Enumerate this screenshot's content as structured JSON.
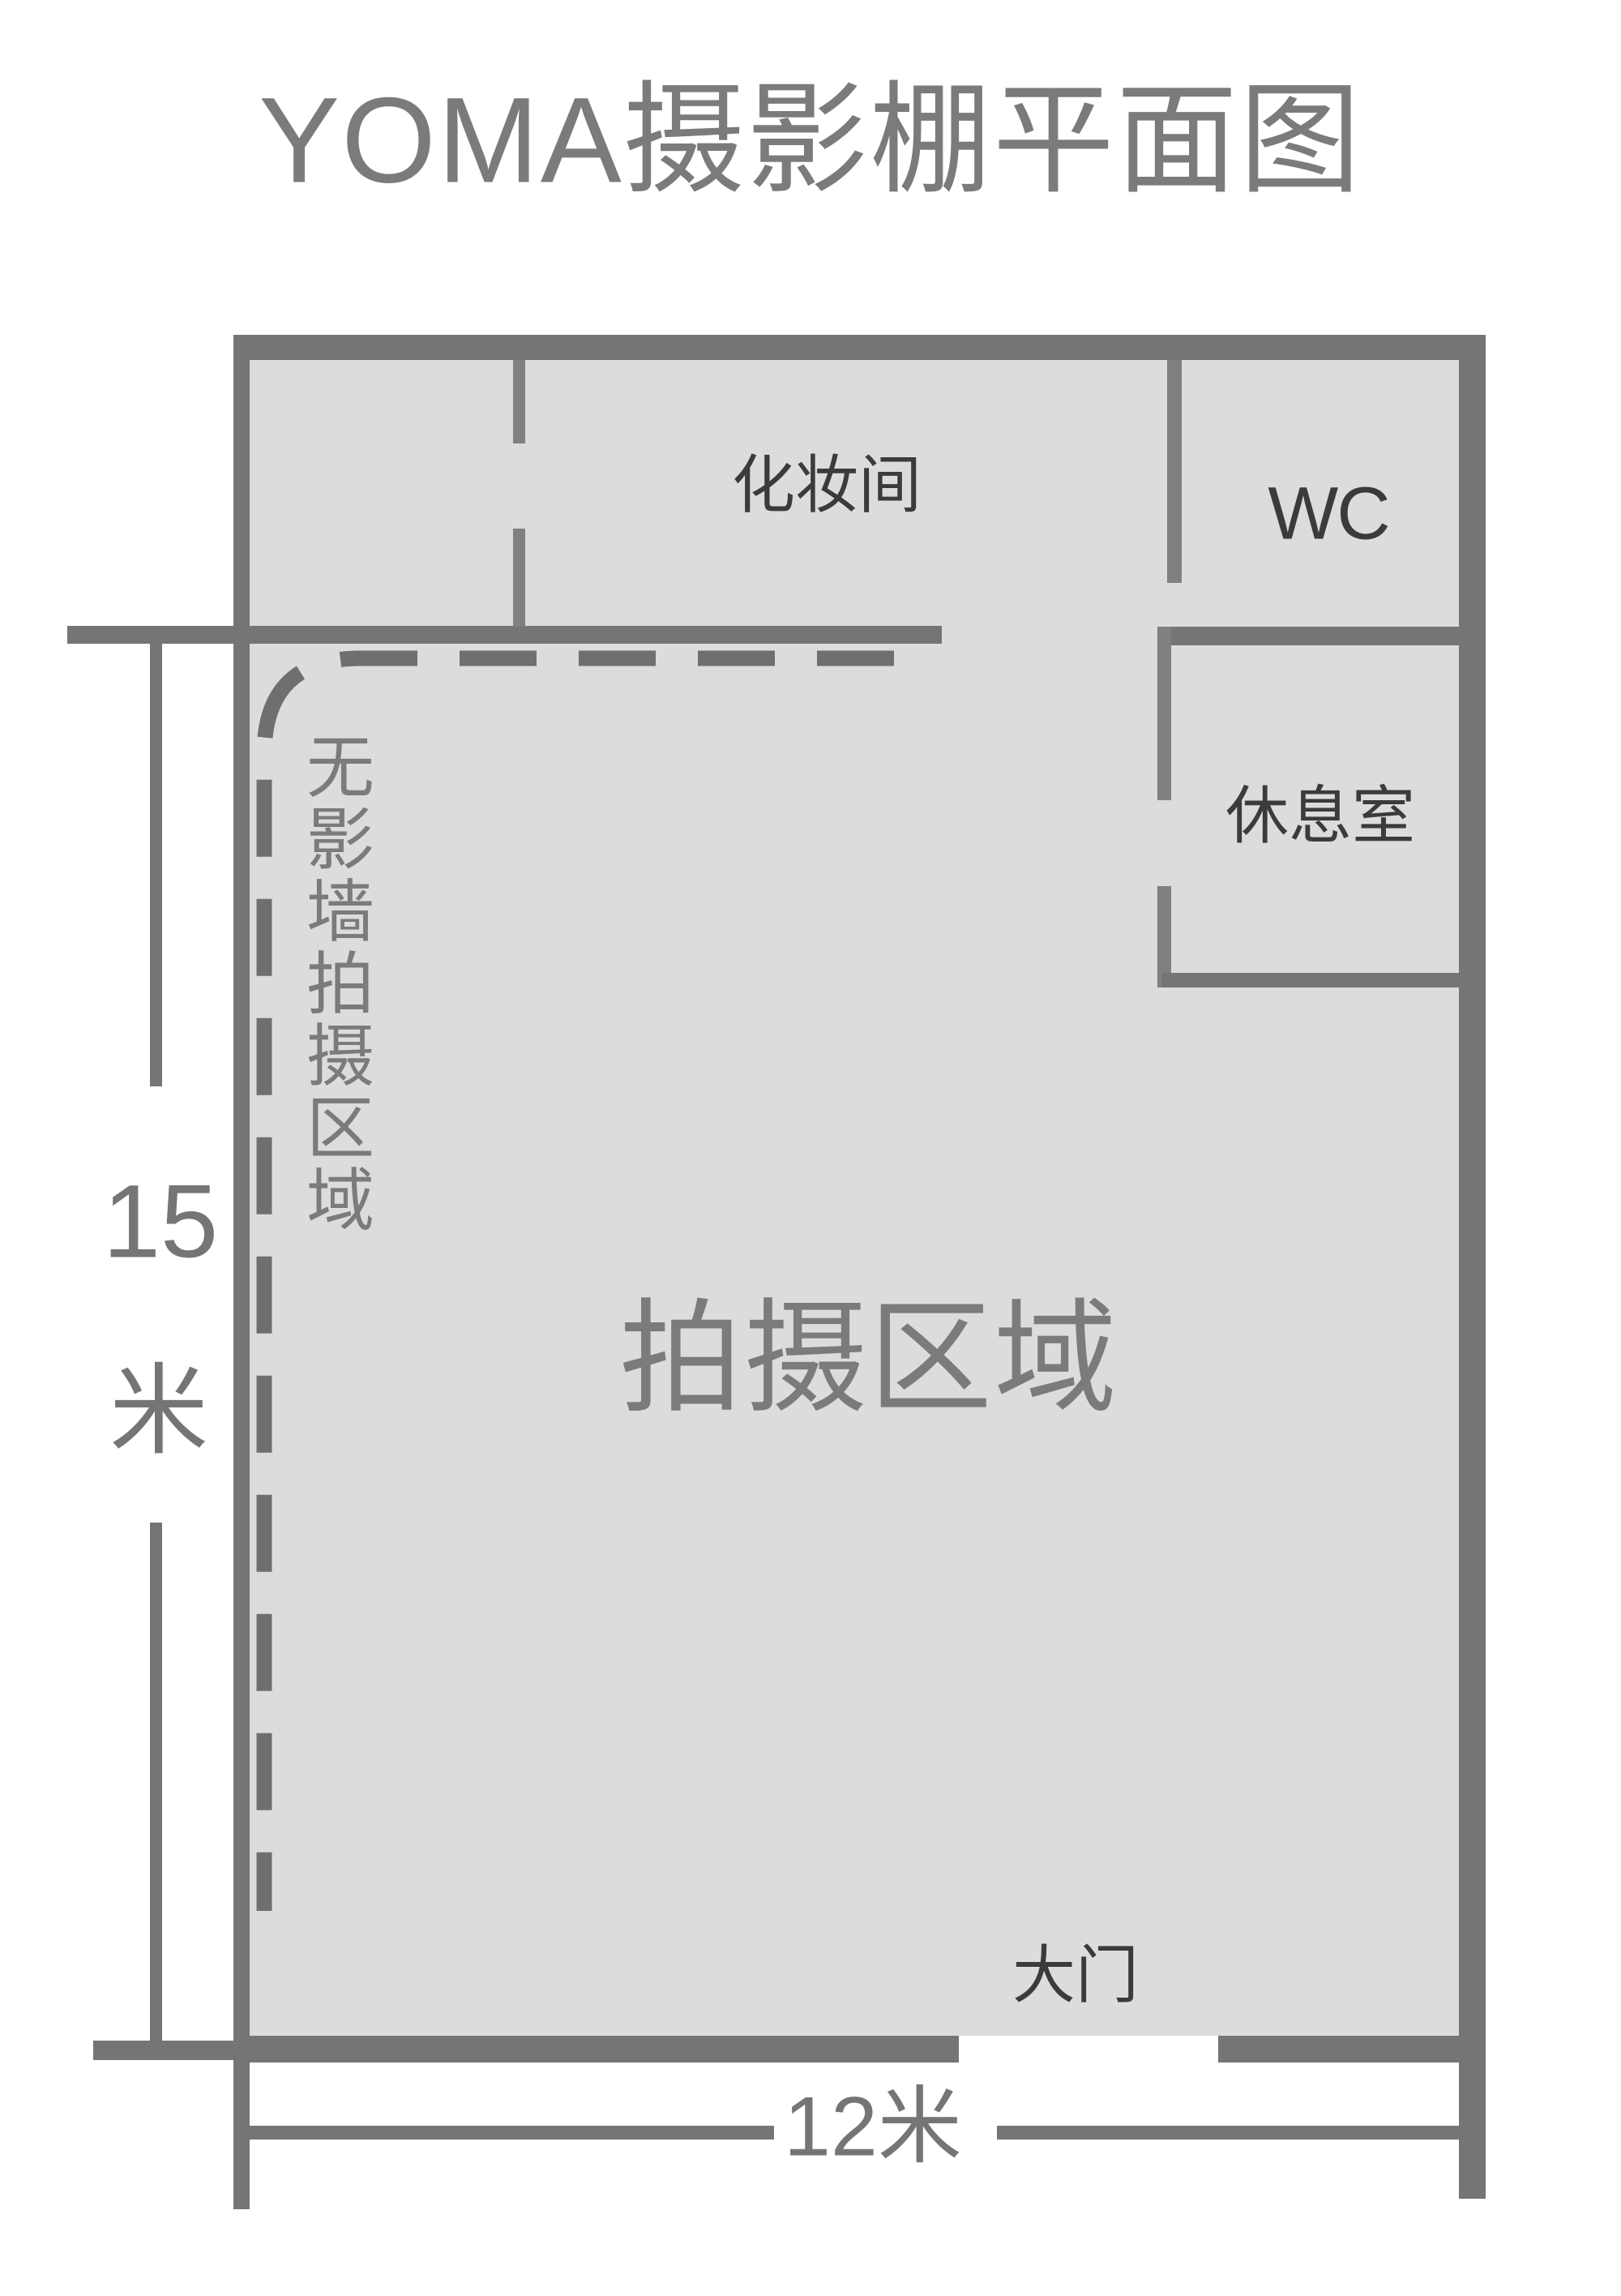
{
  "title": "YOMA摄影棚平面图",
  "rooms": {
    "makeup_label": "化妆间",
    "wc_label": "WC",
    "lounge_label": "休息室",
    "shooting_label": "拍摄区域",
    "seamless_label": "无影墙拍摄区域",
    "gate_label": "大门"
  },
  "dimensions": {
    "height_value": "15",
    "height_unit": "米",
    "width_label": "12米"
  },
  "colors": {
    "wall": "#757575",
    "floor_fill": "#dcdcdc",
    "label_dark": "#3b3b3b",
    "label_gray": "#7b7b7b",
    "background": "#ffffff"
  }
}
